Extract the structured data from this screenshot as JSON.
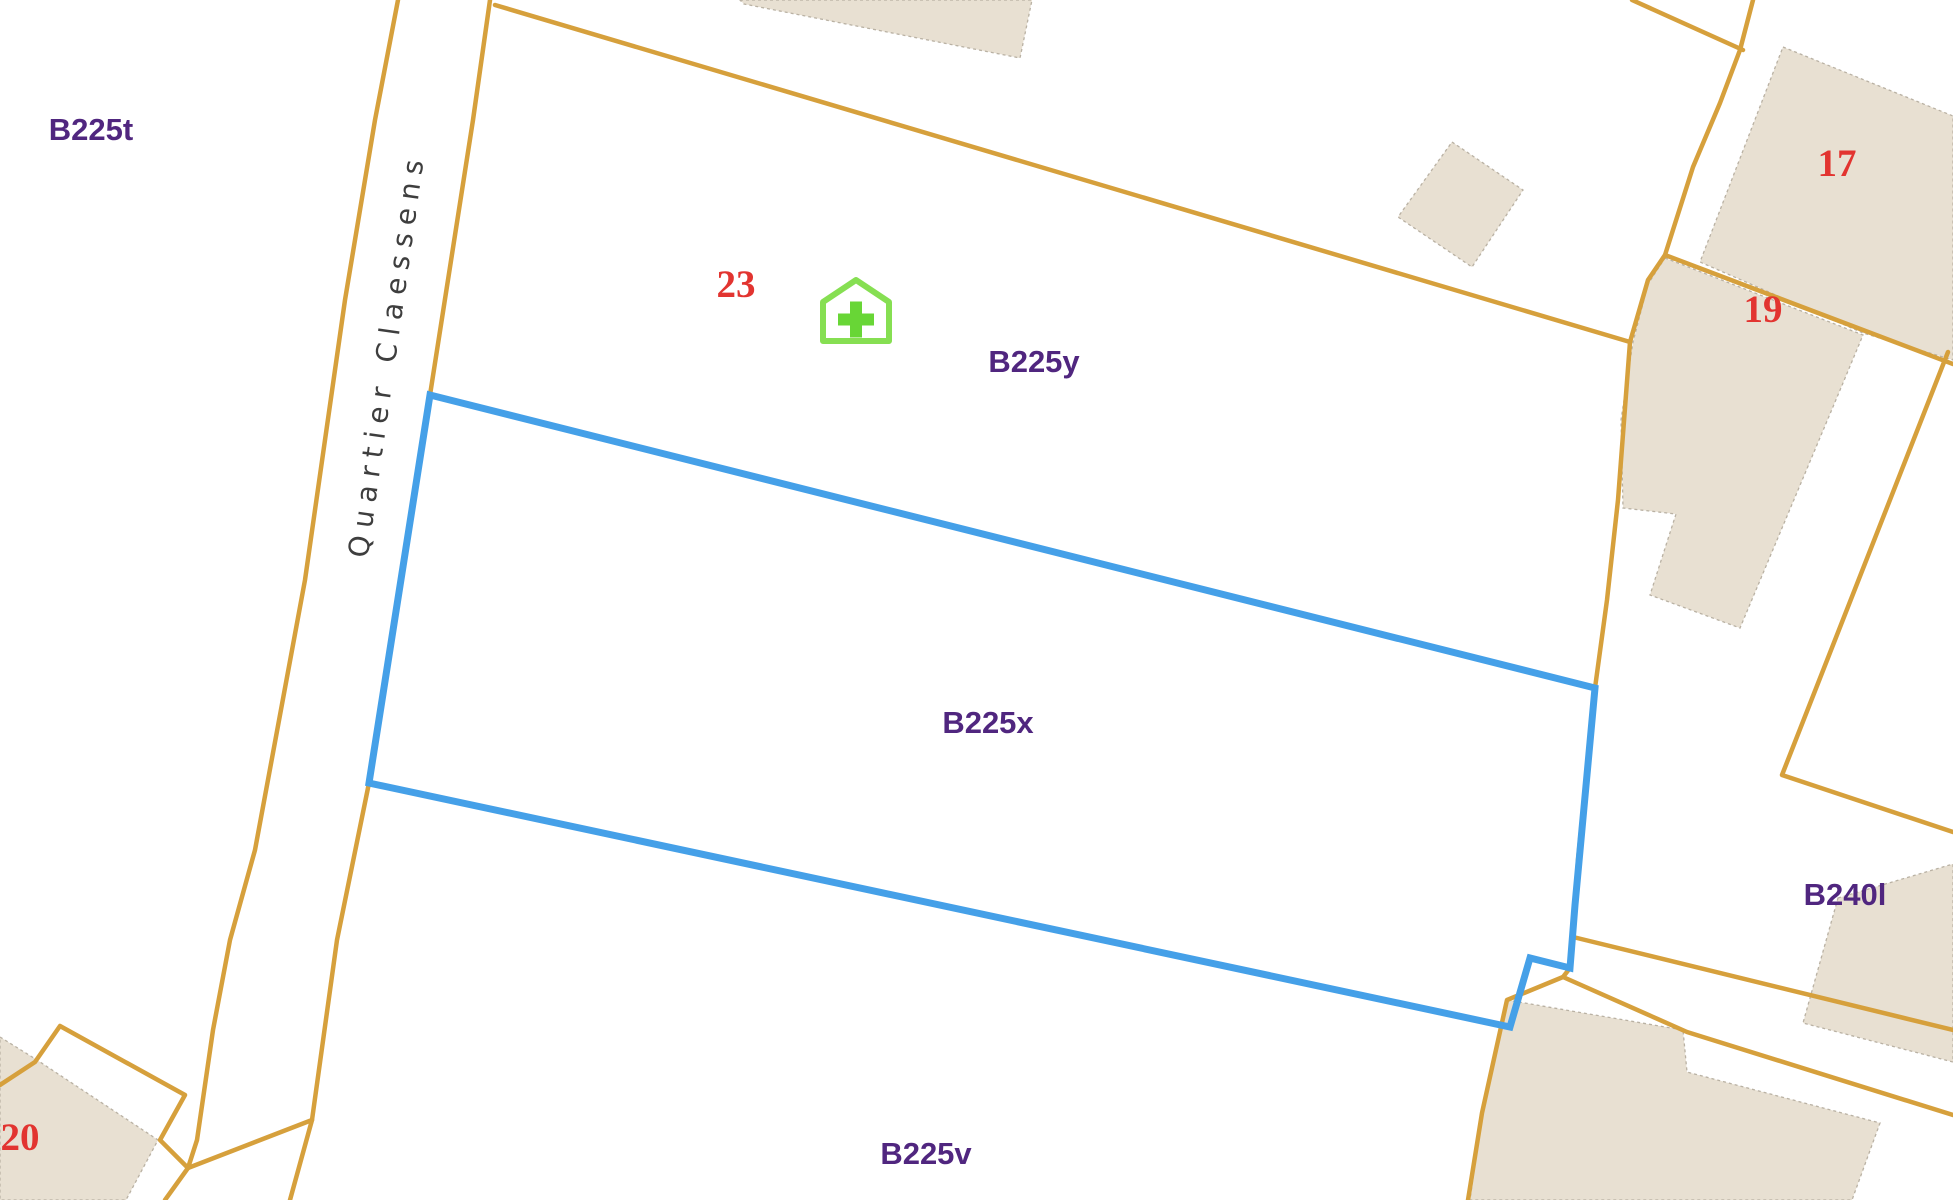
{
  "map": {
    "width": 1953,
    "height": 1200,
    "colors": {
      "background": "#ffffff",
      "road": "#d6a03c",
      "building_fill": "#e8e0d2",
      "building_stroke": "#b9b1a3",
      "selection": "#45a0e8",
      "parcel_label": "#50267f",
      "house_number": "#e23430",
      "street_text": "#3e3e3e",
      "street_halo": "#ffffff",
      "poi_outline": "#86df52",
      "poi_cross": "#68d636"
    },
    "street_label": {
      "text": "Quartier Claessens",
      "x": 396,
      "y": 356,
      "rotation": -82
    },
    "selected_parcel": {
      "name": "B225x",
      "points": [
        [
          430,
          395
        ],
        [
          1595,
          688
        ],
        [
          1575,
          905
        ],
        [
          1570,
          968
        ],
        [
          1530,
          958
        ],
        [
          1510,
          1027
        ],
        [
          369,
          783
        ]
      ]
    },
    "roads": [
      {
        "name": "road-left-edge",
        "points": [
          [
            398,
            0
          ],
          [
            375,
            120
          ],
          [
            345,
            300
          ],
          [
            305,
            580
          ],
          [
            255,
            850
          ],
          [
            230,
            940
          ],
          [
            213,
            1030
          ],
          [
            197,
            1140
          ],
          [
            188,
            1168
          ],
          [
            165,
            1200
          ]
        ]
      },
      {
        "name": "road-right-edge",
        "points": [
          [
            490,
            0
          ],
          [
            473,
            120
          ],
          [
            430,
            395
          ],
          [
            369,
            783
          ],
          [
            337,
            940
          ],
          [
            312,
            1120
          ],
          [
            290,
            1200
          ]
        ]
      },
      {
        "name": "long-diagonal-boundary",
        "points": [
          [
            495,
            5
          ],
          [
            1630,
            342
          ]
        ]
      },
      {
        "name": "top-right-spur",
        "points": [
          [
            1632,
            0
          ],
          [
            1743,
            50
          ]
        ]
      },
      {
        "name": "right-road",
        "points": [
          [
            1753,
            0
          ],
          [
            1740,
            50
          ],
          [
            1720,
            103
          ],
          [
            1693,
            167
          ],
          [
            1665,
            255
          ],
          [
            1648,
            280
          ],
          [
            1630,
            342
          ],
          [
            1618,
            500
          ],
          [
            1607,
            600
          ],
          [
            1595,
            688
          ],
          [
            1578,
            860
          ],
          [
            1575,
            905
          ],
          [
            1570,
            968
          ],
          [
            1563,
            977
          ]
        ]
      },
      {
        "name": "southeast-boundary-a",
        "points": [
          [
            1573,
            937
          ],
          [
            1953,
            1030
          ]
        ]
      },
      {
        "name": "southeast-boundary-b",
        "points": [
          [
            1563,
            977
          ],
          [
            1687,
            1032
          ],
          [
            1953,
            1115
          ]
        ]
      },
      {
        "name": "southwest-boundary",
        "points": [
          [
            1563,
            977
          ],
          [
            1507,
            1000
          ],
          [
            1482,
            1113
          ],
          [
            1468,
            1200
          ]
        ]
      },
      {
        "name": "parcel-19-boundary",
        "points": [
          [
            1665,
            255
          ],
          [
            1863,
            330
          ],
          [
            1953,
            364
          ]
        ]
      },
      {
        "name": "right-v-boundary",
        "points": [
          [
            1948,
            352
          ],
          [
            1782,
            775
          ],
          [
            1953,
            832
          ]
        ]
      },
      {
        "name": "bottom-left-zigzag",
        "points": [
          [
            0,
            1085
          ],
          [
            35,
            1062
          ],
          [
            60,
            1026
          ],
          [
            185,
            1095
          ],
          [
            160,
            1140
          ],
          [
            188,
            1168
          ]
        ]
      },
      {
        "name": "bottom-left-crossing",
        "points": [
          [
            188,
            1168
          ],
          [
            312,
            1120
          ]
        ]
      }
    ],
    "buildings": [
      {
        "name": "building-top-center",
        "points": [
          [
            740,
            0
          ],
          [
            1032,
            0
          ],
          [
            1020,
            58
          ],
          [
            744,
            4
          ]
        ]
      },
      {
        "name": "building-diamond",
        "points": [
          [
            1452,
            142
          ],
          [
            1523,
            190
          ],
          [
            1472,
            267
          ],
          [
            1398,
            217
          ]
        ]
      },
      {
        "name": "building-17",
        "points": [
          [
            1783,
            47
          ],
          [
            1953,
            116
          ],
          [
            1953,
            360
          ],
          [
            1863,
            333
          ],
          [
            1700,
            262
          ]
        ]
      },
      {
        "name": "building-19",
        "points": [
          [
            1665,
            258
          ],
          [
            1863,
            335
          ],
          [
            1843,
            383
          ],
          [
            1740,
            628
          ],
          [
            1650,
            595
          ],
          [
            1676,
            514
          ],
          [
            1623,
            508
          ],
          [
            1621,
            420
          ],
          [
            1633,
            342
          ],
          [
            1648,
            284
          ]
        ]
      },
      {
        "name": "building-b240l",
        "points": [
          [
            1838,
            898
          ],
          [
            1953,
            864
          ],
          [
            1953,
            1062
          ],
          [
            1803,
            1023
          ]
        ]
      },
      {
        "name": "building-bottom-right",
        "points": [
          [
            1507,
            1000
          ],
          [
            1683,
            1030
          ],
          [
            1687,
            1072
          ],
          [
            1880,
            1123
          ],
          [
            1852,
            1200
          ],
          [
            1470,
            1200
          ],
          [
            1482,
            1113
          ]
        ]
      },
      {
        "name": "building-20",
        "points": [
          [
            0,
            1037
          ],
          [
            37,
            1060
          ],
          [
            158,
            1140
          ],
          [
            126,
            1200
          ],
          [
            0,
            1200
          ]
        ]
      }
    ],
    "parcel_labels": [
      {
        "text": "B225t",
        "x": 91,
        "y": 140
      },
      {
        "text": "B225y",
        "x": 1034,
        "y": 372
      },
      {
        "text": "B225x",
        "x": 988,
        "y": 733
      },
      {
        "text": "B225v",
        "x": 926,
        "y": 1164
      },
      {
        "text": "B240l",
        "x": 1845,
        "y": 905
      }
    ],
    "house_numbers": [
      {
        "text": "23",
        "x": 736,
        "y": 297
      },
      {
        "text": "17",
        "x": 1837,
        "y": 176
      },
      {
        "text": "19",
        "x": 1763,
        "y": 322
      },
      {
        "text": "20",
        "x": 20,
        "y": 1150
      }
    ],
    "poi": {
      "name": "pharmacy-house",
      "cx": 856,
      "cy": 311,
      "half_width": 33,
      "roof_y": 280,
      "eave_y": 302,
      "base_y": 341,
      "cross_arm": 18,
      "cross_thickness": 12
    }
  }
}
